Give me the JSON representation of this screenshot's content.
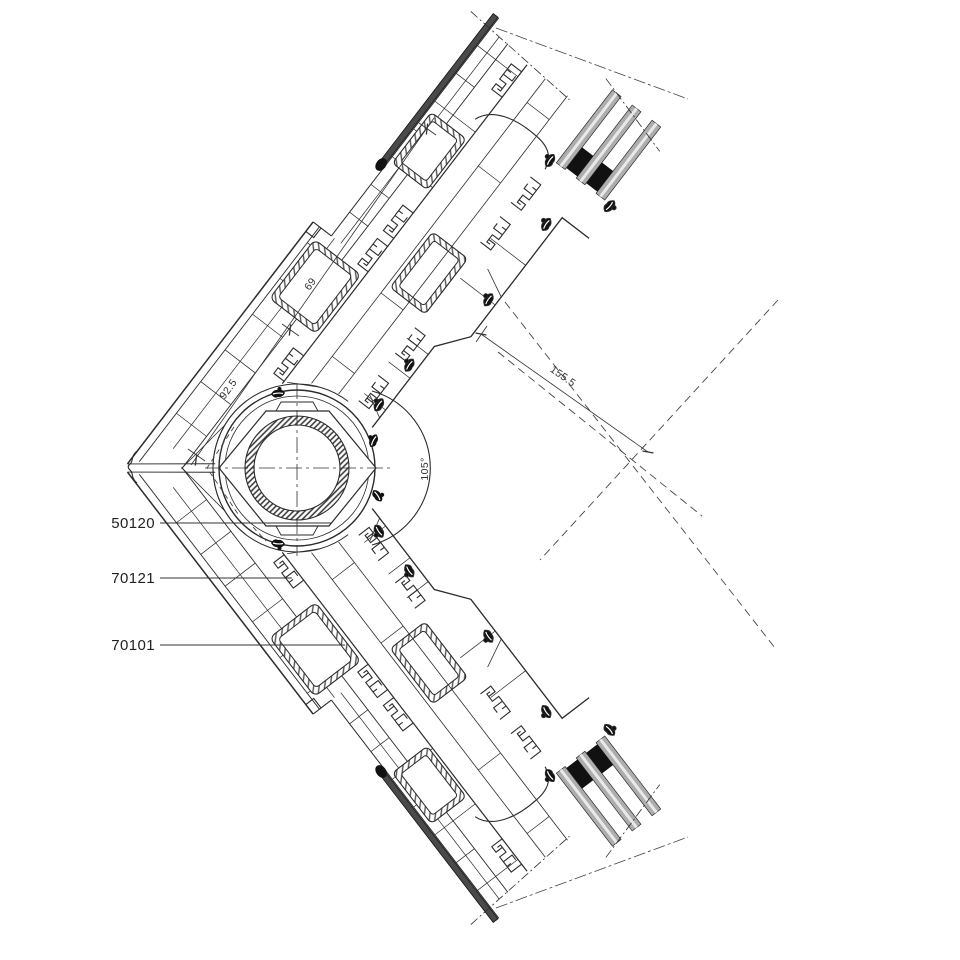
{
  "drawing": {
    "part_labels": [
      "50120",
      "70121",
      "70101"
    ],
    "dimensions": {
      "outer": "92.5",
      "inner": "69",
      "diagonal": "155.5",
      "angle": "105°"
    }
  }
}
